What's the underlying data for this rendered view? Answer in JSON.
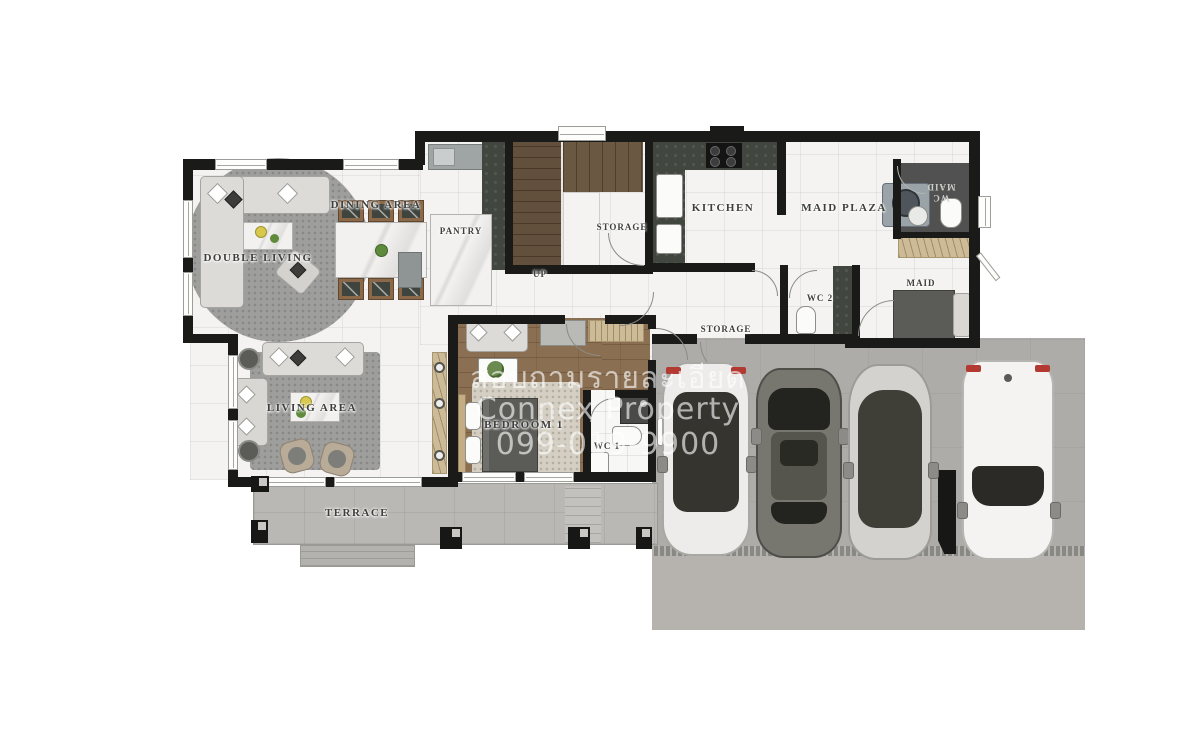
{
  "watermark": {
    "line1": "สอบถามรายละเอียด",
    "line2": "Connex Property",
    "line3": "099-019-9900"
  },
  "rooms": {
    "double_living": "DOUBLE LIVING",
    "dining_area": "DINING AREA",
    "pantry": "PANTRY",
    "storage_by_stairs": "STORAGE",
    "stairs_up": "UP",
    "kitchen": "KITCHEN",
    "maid_plaza": "MAID PLAZA",
    "wc_maid_line1": "WC",
    "wc_maid_line2": "MAID",
    "maid": "MAID",
    "wc_2": "WC 2",
    "storage_mid": "STORAGE",
    "living_area": "LIVING AREA",
    "bedroom_1": "BEDROOM 1",
    "wc_1": "WC 1",
    "terrace": "TERRACE"
  },
  "vehicles": [
    {
      "name": "white hatchback",
      "color": "#edecea"
    },
    {
      "name": "gray sedan",
      "color": "#77766f"
    },
    {
      "name": "silver fastback",
      "color": "#d3d2ce"
    },
    {
      "name": "white suv",
      "color": "#f4f3f1"
    }
  ],
  "colors": {
    "wall": "#1a1a18",
    "marble_floor": "#f4f3f1",
    "bedroom_wood": "#8b6f52",
    "stairs_wood": "#63503c",
    "counter_dark": "#41463f",
    "terrace_concrete": "#b9b8b4",
    "garage_concrete": "#aeaca8",
    "garage_apron": "#b6b3ae",
    "rug_gray": "#9e9e9c",
    "closet_tan": "#cdbb97",
    "bed_dark": "#5b5b57",
    "accent_red": "#b23a32",
    "watermark_white": "#ffffff"
  }
}
